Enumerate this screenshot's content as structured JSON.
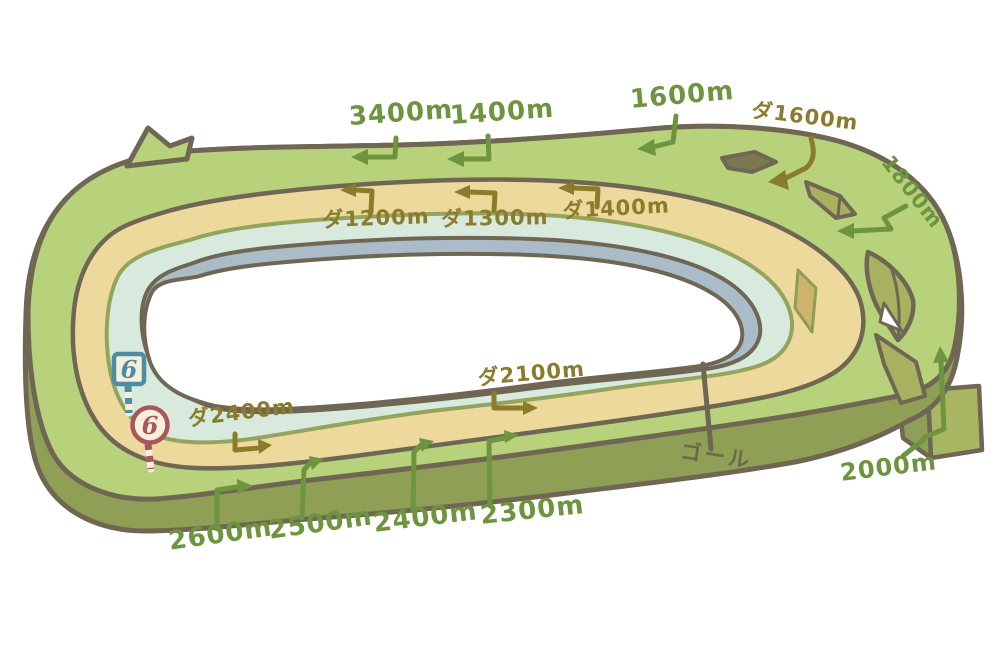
{
  "course": {
    "turf_labels": {
      "m3400": "3400m",
      "m1400": "1400m",
      "m1600": "1600m",
      "m1800": "1800m",
      "m2000": "2000m",
      "m2300": "2300m",
      "m2400": "2400m",
      "m2500": "2500m",
      "m2600": "2600m"
    },
    "dirt_labels": {
      "d1200": "ダ1200m",
      "d1300": "ダ1300m",
      "d1400": "ダ1400m",
      "d1600": "ダ1600m",
      "d2100": "ダ2100m",
      "d2400": "ダ2400m"
    },
    "goal_label": "ゴール",
    "markers": {
      "furlong_blue": "6",
      "furlong_red": "6"
    },
    "colors": {
      "outline_dark": "#6f6753",
      "turf_green": "#b7d27b",
      "dirt_yellow": "#ecd99b",
      "steeple_teal": "#d7eadd",
      "inner_gray_blue": "#a9bcc8",
      "base_olive": "#8f9f55",
      "chute_olive": "#a9b765",
      "crossing_olive": "#a8b160",
      "crossing_tan": "#cdb46d",
      "turf_label_green": "#6e9440",
      "dirt_label_olive": "#8b7b2c",
      "goal_text": "#676b4c",
      "marker_blue": "#4e8ca4",
      "marker_red": "#a8565c",
      "sign_cream": "#f6efdc"
    }
  }
}
